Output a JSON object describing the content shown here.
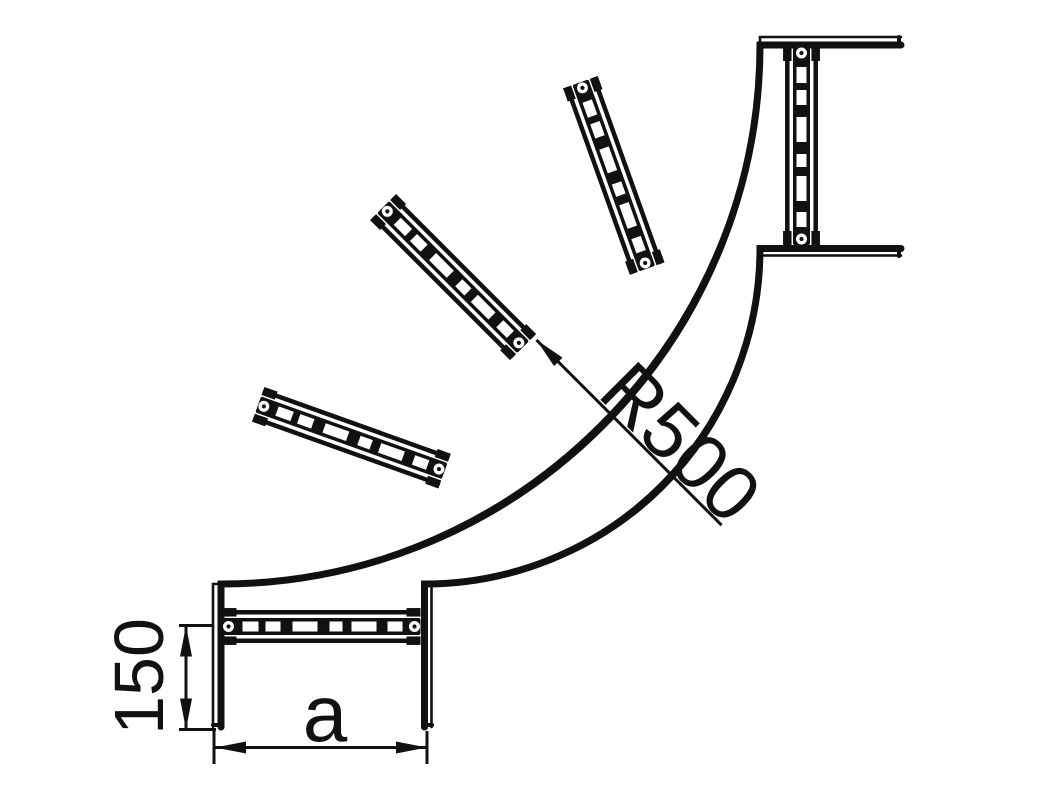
{
  "drawing": {
    "type": "technical-drawing",
    "subject": "90-degree cable ladder bend, plan view",
    "background": "#ffffff",
    "stroke_color": "#111111"
  },
  "canvas": {
    "width": 1038,
    "height": 812
  },
  "bend": {
    "center": {
      "x": 760,
      "y": 584
    },
    "bottom_end_y": 727,
    "right_end_x": 901,
    "rails": [
      {
        "name": "outer-rail-outline",
        "r": 547,
        "width": 2.6
      },
      {
        "name": "outer-rail-flange",
        "r": 539,
        "width": 7
      },
      {
        "name": "inner-rail-flange",
        "r": 335.5,
        "width": 7
      },
      {
        "name": "inner-rail-outline",
        "r": 328.5,
        "width": 2.6
      }
    ],
    "end_caps": [
      [
        213,
        725,
        222,
        725
      ],
      [
        424,
        725,
        432,
        725
      ],
      [
        899,
        37,
        899,
        46
      ],
      [
        899,
        248,
        899,
        256
      ]
    ],
    "rungs": {
      "positions": [
        {
          "x": 321.5,
          "y": 626.5,
          "rot": 0
        },
        {
          "x": 351.4,
          "y": 437.7,
          "rot": 19.7
        },
        {
          "x": 453.1,
          "y": 277.1,
          "rot": 45
        },
        {
          "x": 613.8,
          "y": 175.4,
          "rot": 70.3
        },
        {
          "x": 801.5,
          "y": 146,
          "rot": 90
        }
      ],
      "half_length": 99,
      "band_half_height": 8.5,
      "flange_offset": 14.2,
      "flange_width": 4.5,
      "tab_width": 14,
      "tab_height": 8.5,
      "slot_half_height": 5,
      "slots": [
        [
          -79,
          -63
        ],
        [
          -56,
          -41
        ],
        [
          -29,
          -4
        ],
        [
          8,
          21
        ],
        [
          30,
          55
        ],
        [
          66,
          81
        ]
      ],
      "hole_offset": 93,
      "hole_r": 5.5,
      "hole_dot_r": 2.1
    }
  },
  "dimensions": {
    "stroke_width": 3,
    "arrow": {
      "length": 31,
      "half_width": 6
    },
    "rung_to_end": {
      "label": "150",
      "font_size": 70,
      "extension_lines": [
        [
          179,
          625.5,
          213,
          625.5
        ],
        [
          179,
          729.5,
          216,
          729.5
        ]
      ],
      "line": [
        186,
        625.5,
        186,
        729.5
      ],
      "arrows": [
        {
          "tip": [
            186,
            625.5
          ],
          "dir": -90
        },
        {
          "tip": [
            186,
            729.5
          ],
          "dir": 90
        }
      ],
      "label_pos": {
        "x": 163,
        "y": 676.5,
        "rotate": -90
      }
    },
    "ladder_width": {
      "label": "a",
      "font_size": 80,
      "extension_lines": [
        [
          214,
          728,
          214,
          764
        ],
        [
          427,
          731,
          427,
          764
        ]
      ],
      "line": [
        215,
        747.5,
        427,
        747.5
      ],
      "arrows": [
        {
          "tip": [
            215,
            747.5
          ],
          "dir": 180
        },
        {
          "tip": [
            427,
            747.5
          ],
          "dir": 0
        }
      ],
      "label_pos": {
        "x": 325,
        "y": 741,
        "rotate": 0
      }
    },
    "bend_radius": {
      "label": "R500",
      "font_size": 78,
      "extension_lines": [],
      "line": [
        536.4,
        339.9,
        721.6,
        525.2
      ],
      "arrows": [
        {
          "tip": [
            536.4,
            339.9
          ],
          "dir": 225
        }
      ],
      "label_pos": {
        "x": 661.8,
        "y": 461.2,
        "rotate": 45
      }
    }
  }
}
